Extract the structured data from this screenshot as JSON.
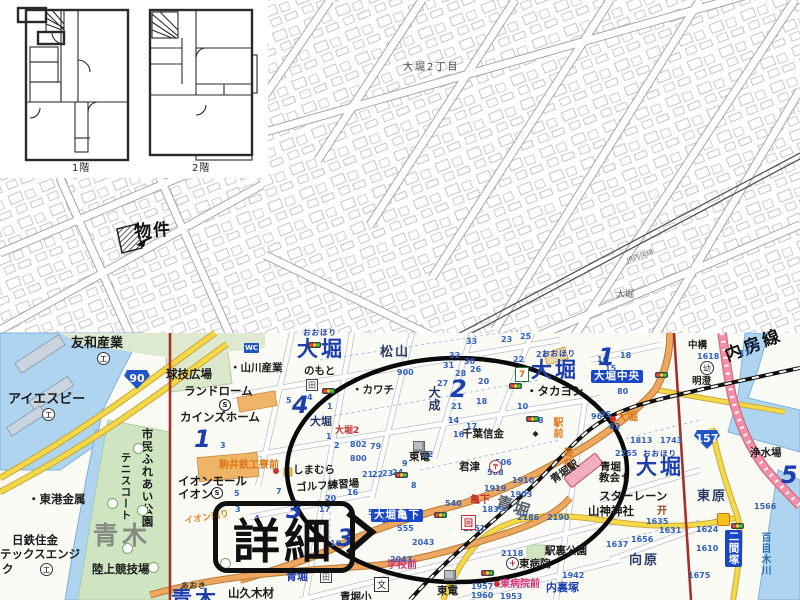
{
  "callouts": {
    "detail": "詳細",
    "property": "物件"
  },
  "floor_plans": {
    "floor1": "1階",
    "floor2": "2階"
  },
  "colors": {
    "accent_blue": "#1d3fae",
    "road_orange": "#eda75f",
    "road_yellow": "#f3d947",
    "road_pink": "#f08fa6",
    "boundary_red": "#a5322a",
    "water": "#aed4f0",
    "park_green": "#cfe5c2",
    "station_pink": "#f2aebe",
    "busstop_orange": "#e07818"
  },
  "map": {
    "labels": [
      {
        "t": "大堀2丁目",
        "x": 403,
        "y": 63,
        "c": "cad",
        "n": "cadastral-district-label"
      },
      {
        "t": "大堀",
        "x": 616,
        "y": 291,
        "c": "cad2"
      },
      {
        "t": "JR内房線",
        "x": 626,
        "y": 258,
        "c": "cadr",
        "r": -19,
        "n": "cadastral-rail-label"
      },
      {
        "t": "友和産業",
        "x": 71,
        "y": 337,
        "c": "fac13"
      },
      {
        "t": "アイエスビー",
        "x": 8,
        "y": 393,
        "c": "fac13"
      },
      {
        "t": "・東港金属",
        "x": 28,
        "y": 494,
        "c": "fac12"
      },
      {
        "t": "日鉄住金",
        "x": 12,
        "y": 535,
        "c": "fac12"
      },
      {
        "t": "テックスエンジ",
        "x": 0,
        "y": 549,
        "c": "fac12"
      },
      {
        "t": "ク",
        "x": 2,
        "y": 564,
        "c": "fac12"
      },
      {
        "t": "陸上競技場",
        "x": 92,
        "y": 564,
        "c": "fac12"
      },
      {
        "t": "市民ふれあい公園",
        "x": 141,
        "y": 428,
        "c": "fac12",
        "v": 1
      },
      {
        "t": "テニスコート",
        "x": 120,
        "y": 452,
        "c": "fac11",
        "v": 1
      },
      {
        "t": "球技広場",
        "x": 166,
        "y": 369,
        "c": "fac12"
      },
      {
        "t": "ランドローム",
        "x": 184,
        "y": 386,
        "c": "fac12"
      },
      {
        "t": "カインズホーム",
        "x": 180,
        "y": 412,
        "c": "fac12"
      },
      {
        "t": "・山川産業",
        "x": 230,
        "y": 363,
        "c": "fac11"
      },
      {
        "t": "のもと",
        "x": 304,
        "y": 366,
        "c": "fac11"
      },
      {
        "t": "・カワチ",
        "x": 352,
        "y": 385,
        "c": "fac11"
      },
      {
        "t": "千葉信金",
        "x": 462,
        "y": 429,
        "c": "fac11"
      },
      {
        "t": "東電",
        "x": 409,
        "y": 452,
        "c": "fac11"
      },
      {
        "t": "君津",
        "x": 459,
        "y": 462,
        "c": "fac11"
      },
      {
        "t": "・タカヨシ",
        "x": 526,
        "y": 386,
        "c": "fac12"
      },
      {
        "t": "しまむら",
        "x": 293,
        "y": 465,
        "c": "fac11"
      },
      {
        "t": "ゴルフ練習場",
        "x": 296,
        "y": 483,
        "c": "fac11",
        "r": -4
      },
      {
        "t": "イオンモール",
        "x": 178,
        "y": 476,
        "c": "fac12"
      },
      {
        "t": "イオン",
        "x": 178,
        "y": 489,
        "c": "fac12"
      },
      {
        "t": "駒井鉄工寮前",
        "x": 219,
        "y": 461,
        "c": "orange10",
        "n": "busstop-label"
      },
      {
        "t": "イオン通り",
        "x": 184,
        "y": 518,
        "c": "orange9",
        "r": -10,
        "n": "street-name"
      },
      {
        "t": "駅前",
        "x": 551,
        "y": 417,
        "c": "orange10",
        "v": 1,
        "n": "busstop-label"
      },
      {
        "t": "局前",
        "x": 561,
        "y": 447,
        "c": "orange10",
        "v": 1,
        "n": "busstop-label"
      },
      {
        "t": "大堀",
        "x": 616,
        "y": 411,
        "c": "orange11",
        "n": "busstop-label"
      },
      {
        "t": "大堀2",
        "x": 335,
        "y": 427,
        "c": "red9"
      },
      {
        "t": "亀下",
        "x": 470,
        "y": 496,
        "c": "red10"
      },
      {
        "t": "学校前",
        "x": 387,
        "y": 561,
        "c": "mag10",
        "n": "busstop-label"
      },
      {
        "t": "東病院前",
        "x": 500,
        "y": 580,
        "c": "mag10",
        "n": "busstop-label"
      },
      {
        "t": "おおほり",
        "x": 303,
        "y": 329,
        "c": "furi"
      },
      {
        "t": "大堀",
        "x": 297,
        "y": 339,
        "c": "big-area",
        "n": "district-label"
      },
      {
        "t": "おおほり",
        "x": 542,
        "y": 350,
        "c": "furi"
      },
      {
        "t": "大堀",
        "x": 531,
        "y": 360,
        "c": "big-area",
        "n": "district-label"
      },
      {
        "t": "おおほり",
        "x": 643,
        "y": 450,
        "c": "furi"
      },
      {
        "t": "大堀",
        "x": 636,
        "y": 457,
        "c": "big-area",
        "n": "district-label"
      },
      {
        "t": "松山",
        "x": 380,
        "y": 346,
        "c": "area13"
      },
      {
        "t": "大成",
        "x": 428,
        "y": 386,
        "c": "area12",
        "v": 1
      },
      {
        "t": "大堀",
        "x": 310,
        "y": 416,
        "c": "area11"
      },
      {
        "t": "東原",
        "x": 697,
        "y": 490,
        "c": "area13"
      },
      {
        "t": "向原",
        "x": 629,
        "y": 554,
        "c": "area13"
      },
      {
        "t": "青堀",
        "x": 499,
        "y": 494,
        "c": "area-gray",
        "r": 18
      },
      {
        "t": "青木",
        "x": 93,
        "y": 523,
        "c": "aoki",
        "n": "district-label"
      },
      {
        "t": "あおき",
        "x": 181,
        "y": 582,
        "c": "furi2"
      },
      {
        "t": "青木",
        "x": 171,
        "y": 589,
        "c": "big-area"
      },
      {
        "t": "内裏塚",
        "x": 546,
        "y": 582,
        "c": "bluename"
      },
      {
        "t": "青堀",
        "x": 286,
        "y": 571,
        "c": "bluename"
      },
      {
        "t": "青堀駅",
        "x": 549,
        "y": 477,
        "c": "fac11",
        "r": -35,
        "n": "station-label"
      },
      {
        "t": "青堀",
        "x": 600,
        "y": 462,
        "c": "fac11"
      },
      {
        "t": "教会✝",
        "x": 599,
        "y": 473,
        "c": "fac11"
      },
      {
        "t": "スターレーン",
        "x": 599,
        "y": 491,
        "c": "fac12"
      },
      {
        "t": "山神神社",
        "x": 588,
        "y": 506,
        "c": "fac12"
      },
      {
        "t": "駅裏公園",
        "x": 545,
        "y": 546,
        "c": "fac11"
      },
      {
        "t": "東病院",
        "x": 519,
        "y": 559,
        "c": "fac11"
      },
      {
        "t": "浄水場",
        "x": 750,
        "y": 448,
        "c": "fac11"
      },
      {
        "t": "中構",
        "x": 688,
        "y": 341,
        "c": "fac10"
      },
      {
        "t": "明澄",
        "x": 692,
        "y": 377,
        "c": "fac10"
      },
      {
        "t": "東電",
        "x": 437,
        "y": 586,
        "c": "fac11"
      },
      {
        "t": "山久木材",
        "x": 228,
        "y": 588,
        "c": "fac12"
      },
      {
        "t": "青堀小",
        "x": 340,
        "y": 592,
        "c": "fac11"
      },
      {
        "t": "大堀中央",
        "x": 591,
        "y": 370,
        "c": "bluebox",
        "n": "intersection-label"
      },
      {
        "t": "大堀亀下",
        "x": 371,
        "y": 509,
        "c": "bluebox",
        "n": "intersection-label"
      },
      {
        "t": "二間塚",
        "x": 725,
        "y": 530,
        "c": "bluebox",
        "v": 1,
        "n": "intersection-label"
      },
      {
        "t": "百目木川",
        "x": 759,
        "y": 532,
        "c": "river",
        "v": 1,
        "n": "river-label"
      },
      {
        "t": "内房線",
        "x": 723,
        "y": 349,
        "c": "rail-name",
        "r": -21,
        "n": "rail-line-label"
      },
      {
        "t": "1階",
        "x": 72,
        "y": 164,
        "c": "fp",
        "n": "floor1-label"
      },
      {
        "t": "2階",
        "x": 192,
        "y": 164,
        "c": "fp",
        "n": "floor2-label"
      }
    ],
    "big_numbers": [
      {
        "t": "1",
        "x": 194,
        "y": 425
      },
      {
        "t": "4",
        "x": 292,
        "y": 391
      },
      {
        "t": "2",
        "x": 450,
        "y": 375
      },
      {
        "t": "1",
        "x": 598,
        "y": 343
      },
      {
        "t": "3",
        "x": 337,
        "y": 524
      },
      {
        "t": "3",
        "x": 286,
        "y": 496
      },
      {
        "t": "5",
        "x": 781,
        "y": 461
      }
    ],
    "numbers": [
      {
        "t": "900",
        "x": 397,
        "y": 368
      },
      {
        "t": "802",
        "x": 350,
        "y": 440
      },
      {
        "t": "79",
        "x": 370,
        "y": 442
      },
      {
        "t": "800",
        "x": 350,
        "y": 454
      },
      {
        "t": "33",
        "x": 466,
        "y": 337
      },
      {
        "t": "23",
        "x": 501,
        "y": 335
      },
      {
        "t": "25",
        "x": 520,
        "y": 332
      },
      {
        "t": "21",
        "x": 536,
        "y": 350
      },
      {
        "t": "22",
        "x": 513,
        "y": 355
      },
      {
        "t": "32",
        "x": 449,
        "y": 351
      },
      {
        "t": "31",
        "x": 443,
        "y": 361
      },
      {
        "t": "30",
        "x": 464,
        "y": 357
      },
      {
        "t": "28",
        "x": 455,
        "y": 369
      },
      {
        "t": "26",
        "x": 470,
        "y": 365
      },
      {
        "t": "20",
        "x": 478,
        "y": 377
      },
      {
        "t": "27",
        "x": 437,
        "y": 379
      },
      {
        "t": "18",
        "x": 476,
        "y": 397
      },
      {
        "t": "21",
        "x": 451,
        "y": 402
      },
      {
        "t": "14",
        "x": 448,
        "y": 416
      },
      {
        "t": "17",
        "x": 466,
        "y": 422
      },
      {
        "t": "16",
        "x": 453,
        "y": 430
      },
      {
        "t": "12",
        "x": 422,
        "y": 450
      },
      {
        "t": "9",
        "x": 402,
        "y": 459
      },
      {
        "t": "8",
        "x": 411,
        "y": 481
      },
      {
        "t": "10",
        "x": 517,
        "y": 402
      },
      {
        "t": "8",
        "x": 538,
        "y": 416
      },
      {
        "t": "96",
        "x": 591,
        "y": 412
      },
      {
        "t": "95",
        "x": 600,
        "y": 410
      },
      {
        "t": "80",
        "x": 617,
        "y": 387
      },
      {
        "t": "82",
        "x": 609,
        "y": 422
      },
      {
        "t": "15",
        "x": 605,
        "y": 364
      },
      {
        "t": "16",
        "x": 597,
        "y": 355
      },
      {
        "t": "18",
        "x": 620,
        "y": 351
      },
      {
        "t": "13",
        "x": 746,
        "y": 340
      },
      {
        "t": "17",
        "x": 739,
        "y": 349
      },
      {
        "t": "1618",
        "x": 697,
        "y": 352
      },
      {
        "t": "1813",
        "x": 630,
        "y": 436
      },
      {
        "t": "1743",
        "x": 660,
        "y": 436
      },
      {
        "t": "2255",
        "x": 615,
        "y": 449
      },
      {
        "t": "2186",
        "x": 517,
        "y": 513
      },
      {
        "t": "2190",
        "x": 547,
        "y": 513
      },
      {
        "t": "2118",
        "x": 501,
        "y": 549
      },
      {
        "t": "1942",
        "x": 562,
        "y": 571
      },
      {
        "t": "1635",
        "x": 646,
        "y": 517
      },
      {
        "t": "1631",
        "x": 659,
        "y": 526
      },
      {
        "t": "1656",
        "x": 631,
        "y": 535
      },
      {
        "t": "1637",
        "x": 606,
        "y": 540
      },
      {
        "t": "1624",
        "x": 696,
        "y": 525
      },
      {
        "t": "1610",
        "x": 696,
        "y": 544
      },
      {
        "t": "1675",
        "x": 688,
        "y": 571
      },
      {
        "t": "1566",
        "x": 754,
        "y": 502
      },
      {
        "t": "540",
        "x": 445,
        "y": 499
      },
      {
        "t": "555",
        "x": 397,
        "y": 524
      },
      {
        "t": "506",
        "x": 495,
        "y": 458
      },
      {
        "t": "508",
        "x": 487,
        "y": 468
      },
      {
        "t": "1910",
        "x": 512,
        "y": 476
      },
      {
        "t": "1919",
        "x": 484,
        "y": 484
      },
      {
        "t": "1903",
        "x": 510,
        "y": 490
      },
      {
        "t": "1839",
        "x": 482,
        "y": 505
      },
      {
        "t": "1951",
        "x": 463,
        "y": 524
      },
      {
        "t": "2043",
        "x": 412,
        "y": 538
      },
      {
        "t": "2043",
        "x": 390,
        "y": 555
      },
      {
        "t": "1957",
        "x": 471,
        "y": 582
      },
      {
        "t": "1960",
        "x": 471,
        "y": 591
      },
      {
        "t": "1953",
        "x": 500,
        "y": 592
      },
      {
        "t": "21",
        "x": 362,
        "y": 470
      },
      {
        "t": "22",
        "x": 372,
        "y": 470
      },
      {
        "t": "23",
        "x": 382,
        "y": 469
      },
      {
        "t": "24",
        "x": 392,
        "y": 468
      },
      {
        "t": "5",
        "x": 234,
        "y": 489
      },
      {
        "t": "7",
        "x": 276,
        "y": 487
      },
      {
        "t": "3",
        "x": 235,
        "y": 505
      },
      {
        "t": "4",
        "x": 254,
        "y": 514
      },
      {
        "t": "10",
        "x": 330,
        "y": 539
      },
      {
        "t": "17",
        "x": 319,
        "y": 505
      },
      {
        "t": "20",
        "x": 325,
        "y": 494
      },
      {
        "t": "16",
        "x": 347,
        "y": 488
      },
      {
        "t": "6",
        "x": 381,
        "y": 516
      },
      {
        "t": "5",
        "x": 368,
        "y": 508
      },
      {
        "t": "1",
        "x": 326,
        "y": 432
      },
      {
        "t": "2",
        "x": 334,
        "y": 441
      },
      {
        "t": "3",
        "x": 220,
        "y": 441
      },
      {
        "t": "5",
        "x": 286,
        "y": 396
      },
      {
        "t": "4",
        "x": 307,
        "y": 393
      },
      {
        "t": "1",
        "x": 327,
        "y": 402
      }
    ],
    "icons": [
      {
        "k": "wc",
        "x": 244,
        "y": 343,
        "g": "WC"
      },
      {
        "k": "factory",
        "x": 97,
        "y": 352,
        "g": "工"
      },
      {
        "k": "factory",
        "x": 42,
        "y": 408,
        "g": "工"
      },
      {
        "k": "factory",
        "x": 40,
        "y": 563,
        "g": "工"
      },
      {
        "k": "store",
        "x": 219,
        "y": 399,
        "g": "S"
      },
      {
        "k": "store",
        "x": 211,
        "y": 487,
        "g": "S"
      },
      {
        "k": "field",
        "x": 306,
        "y": 379,
        "g": "田"
      },
      {
        "k": "field",
        "x": 320,
        "y": 571,
        "g": "田"
      },
      {
        "k": "seven",
        "x": 515,
        "y": 367,
        "g": "7"
      },
      {
        "k": "post",
        "x": 489,
        "y": 460,
        "g": "〒"
      },
      {
        "k": "bank",
        "x": 531,
        "y": 429,
        "g": "◆"
      },
      {
        "k": "spiral",
        "x": 461,
        "y": 515,
        "g": "回"
      },
      {
        "k": "hosp",
        "x": 506,
        "y": 557,
        "g": "+"
      },
      {
        "k": "torii",
        "x": 657,
        "y": 504,
        "g": "开"
      },
      {
        "k": "kind",
        "x": 700,
        "y": 361,
        "g": "幼"
      },
      {
        "k": "school",
        "x": 374,
        "y": 577,
        "g": "文"
      },
      {
        "k": "gas",
        "x": 717,
        "y": 513,
        "g": ""
      },
      {
        "k": "cube",
        "x": 413,
        "y": 441,
        "g": ""
      },
      {
        "k": "cube",
        "x": 444,
        "y": 570,
        "g": ""
      },
      {
        "k": "tl",
        "x": 308,
        "y": 342,
        "g": ""
      },
      {
        "k": "tl",
        "x": 322,
        "y": 388,
        "g": ""
      },
      {
        "k": "tl",
        "x": 509,
        "y": 383,
        "g": ""
      },
      {
        "k": "tl",
        "x": 526,
        "y": 416,
        "g": ""
      },
      {
        "k": "tl",
        "x": 395,
        "y": 472,
        "g": ""
      },
      {
        "k": "tl",
        "x": 434,
        "y": 512,
        "g": ""
      },
      {
        "k": "tl",
        "x": 655,
        "y": 372,
        "g": ""
      },
      {
        "k": "tl",
        "x": 481,
        "y": 570,
        "g": ""
      },
      {
        "k": "tl",
        "x": 731,
        "y": 523,
        "g": ""
      },
      {
        "k": "dot",
        "x": 610,
        "y": 416,
        "g": ""
      },
      {
        "k": "dot",
        "x": 273,
        "y": 468,
        "g": ""
      },
      {
        "k": "dot",
        "x": 494,
        "y": 581,
        "g": ""
      },
      {
        "k": "tree",
        "x": 133,
        "y": 443,
        "g": ""
      },
      {
        "k": "tree",
        "x": 137,
        "y": 505,
        "g": ""
      },
      {
        "k": "tree",
        "x": 122,
        "y": 543,
        "g": ""
      },
      {
        "k": "tree",
        "x": 148,
        "y": 562,
        "g": ""
      },
      {
        "k": "tree",
        "x": 220,
        "y": 558,
        "g": ""
      },
      {
        "k": "tree",
        "x": 107,
        "y": 498,
        "g": ""
      }
    ],
    "shields": [
      {
        "t": "90",
        "x": 124,
        "y": 370
      },
      {
        "t": "157",
        "x": 694,
        "y": 430
      }
    ]
  }
}
